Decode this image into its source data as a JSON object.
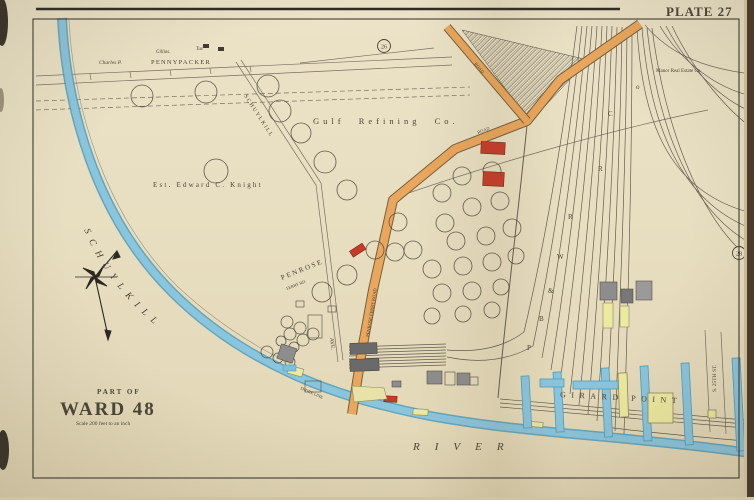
{
  "plate_label": "PLATE 27",
  "badges": {
    "top": "26",
    "right": "28"
  },
  "title_block": {
    "part_of": "PART OF",
    "ward": "WARD 48",
    "scale": "Scale 200 feet to an inch"
  },
  "water": {
    "river_name": "SCHUYLKILL",
    "river_word": "RIVER"
  },
  "places": {
    "gulf": "Gulf Refining Co.",
    "knight": "Est. Edward C. Knight",
    "charles": "Charles P.",
    "pennypacker": "PENNYPACKER",
    "pennypacker_note_1": "Gillias.",
    "pennypacker_note_2": "Tux",
    "manor": "Manor Real Estate Co.",
    "girard_point": "GIRARD POINT"
  },
  "streets": {
    "schuylkill_ave": "SCHUYLKILL",
    "schuylkill_ave_suffix": "AVE.",
    "penrose": "PENROSE",
    "penrose_suffix": "FERRY RD.",
    "road_a": "PENROSE FERRY ROAD",
    "road_a_short": "ROAD",
    "road_b": "ROAD",
    "shore_line": "SHORE LINE",
    "s25th": "S. 25TH ST."
  },
  "railroad_letters": [
    "P",
    "B",
    "&",
    "W",
    "R",
    "R",
    "C",
    "o"
  ],
  "colors": {
    "paper": "#e9dfc2",
    "water": "#8ac5de",
    "water_edge": "#4f9cbb",
    "road_orange": "#eaa65c",
    "building_red": "#c63b2a",
    "building_gray": "#8d8d8d",
    "building_yellow": "#ece9a0",
    "ink": "#46413a"
  }
}
